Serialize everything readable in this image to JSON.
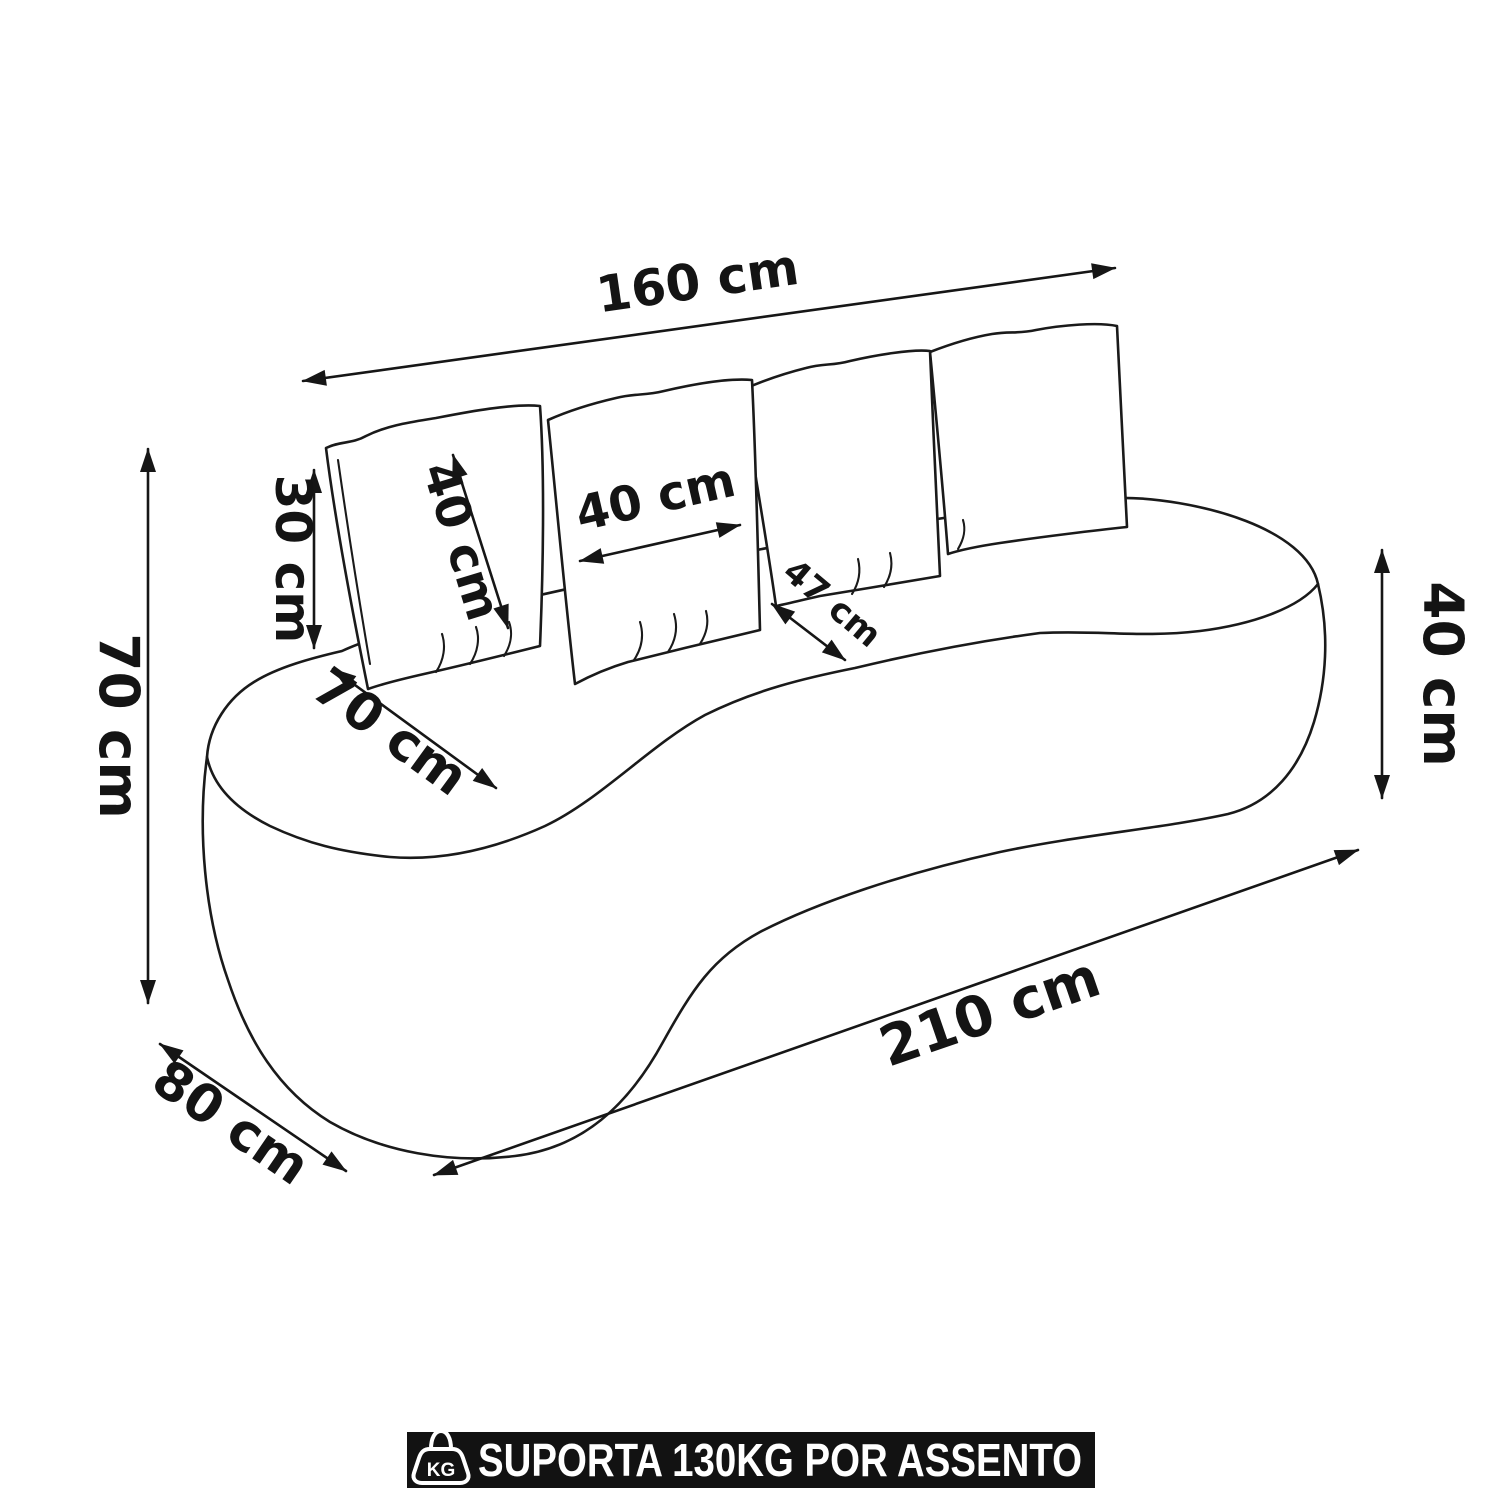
{
  "page": {
    "background": "#ffffff",
    "ink_color": "#1a1a1a",
    "subject": "curved-sofa-dimension-diagram"
  },
  "dimensions": {
    "back_width": "160 cm",
    "overall_height": "70 cm",
    "back_pillow_drop": "30 cm",
    "pillow_height": "40 cm",
    "pillow_width": "40 cm",
    "seat_depth_center": "47 cm",
    "seat_depth_left": "70 cm",
    "seat_height": "40 cm",
    "overall_length": "210 cm",
    "overall_depth": "80 cm"
  },
  "banner": {
    "text": "SUPORTA 130KG POR ASSENTO",
    "icon_label": "KG",
    "background": "#121212",
    "text_color": "#ffffff"
  }
}
